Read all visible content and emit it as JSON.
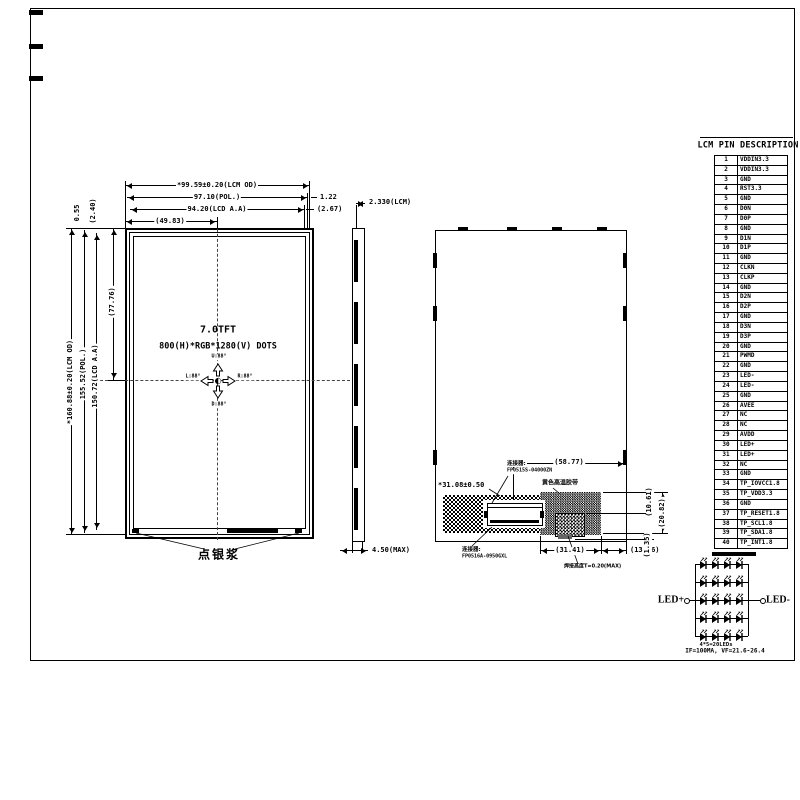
{
  "pin_table": {
    "title": "LCM PIN DESCRIPTION",
    "rows": [
      {
        "p": "1",
        "n": "VDDIN3.3"
      },
      {
        "p": "2",
        "n": "VDDIN3.3"
      },
      {
        "p": "3",
        "n": "GND"
      },
      {
        "p": "4",
        "n": "RST3.3"
      },
      {
        "p": "5",
        "n": "GND"
      },
      {
        "p": "6",
        "n": "D0N"
      },
      {
        "p": "7",
        "n": "D0P"
      },
      {
        "p": "8",
        "n": "GND"
      },
      {
        "p": "9",
        "n": "D1N"
      },
      {
        "p": "10",
        "n": "D1P"
      },
      {
        "p": "11",
        "n": "GND"
      },
      {
        "p": "12",
        "n": "CLKN"
      },
      {
        "p": "13",
        "n": "CLKP"
      },
      {
        "p": "14",
        "n": "GND"
      },
      {
        "p": "15",
        "n": "D2N"
      },
      {
        "p": "16",
        "n": "D2P"
      },
      {
        "p": "17",
        "n": "GND"
      },
      {
        "p": "18",
        "n": "D3N"
      },
      {
        "p": "19",
        "n": "D3P"
      },
      {
        "p": "20",
        "n": "GND"
      },
      {
        "p": "21",
        "n": "PWMD"
      },
      {
        "p": "22",
        "n": "GND"
      },
      {
        "p": "23",
        "n": "LED-"
      },
      {
        "p": "24",
        "n": "LED-"
      },
      {
        "p": "25",
        "n": "GND"
      },
      {
        "p": "26",
        "n": "AVEE"
      },
      {
        "p": "27",
        "n": "NC"
      },
      {
        "p": "28",
        "n": "NC"
      },
      {
        "p": "29",
        "n": "AVDD"
      },
      {
        "p": "30",
        "n": "LED+"
      },
      {
        "p": "31",
        "n": "LED+"
      },
      {
        "p": "32",
        "n": "NC"
      },
      {
        "p": "33",
        "n": "GND"
      },
      {
        "p": "34",
        "n": "TP_IOVCC1.8"
      },
      {
        "p": "35",
        "n": "TP_VDD3.3"
      },
      {
        "p": "36",
        "n": "GND"
      },
      {
        "p": "37",
        "n": "TP_RESET1.8"
      },
      {
        "p": "38",
        "n": "TP_SCL1.8"
      },
      {
        "p": "39",
        "n": "TP_SDA1.8"
      },
      {
        "p": "40",
        "n": "TP_INT1.8"
      }
    ]
  },
  "front_view": {
    "title": "7.0TFT",
    "resolution": "800(H)*RGB*1280(V) DOTS",
    "angles": {
      "up": "U:88°",
      "down": "D:88°",
      "left": "L:88°",
      "right": "R:88°"
    },
    "silver_paste_label": "点银浆"
  },
  "dims": {
    "lcm_width": "*99.59±0.20(LCM OD)",
    "pol_width": "97.10(POL.)",
    "aa_width": "94.20(LCD A.A)",
    "half_width": "(49.83)",
    "pol_gap": "1.22",
    "aa_gap": "(2.67)",
    "top_offset1": "0.55",
    "top_offset2": "(2.40)",
    "half_height": "(77.76)",
    "lcm_height": "*160.88±0.20(LCM OD)",
    "pol_height": "155.52(POL.)",
    "aa_height": "150.72(LCD A.A)",
    "lcm_thickness": "2.330(LCM)",
    "max_thickness": "4.50(MAX)",
    "connector_span": "(58.77)",
    "fpc_width": "*31.08±0.50",
    "tape_width": "(31.41)",
    "edge_offset": "(13.06)",
    "tape_h1": "(10.61)",
    "tape_h2": "(20.82)",
    "tab_h": "(1.35)"
  },
  "back_view": {
    "connector_label": "连接器:",
    "connector_top_part": "FP0515S-04000ZN",
    "connector_bottom_part": "FP0516A-0950GXL",
    "tape_label": "黄色高温胶带",
    "solder_label": "焊接高度T=0.20(MAX)"
  },
  "led_circuit": {
    "anode": "LED+",
    "cathode": "LED-",
    "count": "4*5=20LEDs",
    "spec": "IF=100MA, VF=21.6-26.4",
    "rows": 5,
    "cols": 4
  },
  "colors": {
    "line": "#000000",
    "bg": "#ffffff"
  }
}
